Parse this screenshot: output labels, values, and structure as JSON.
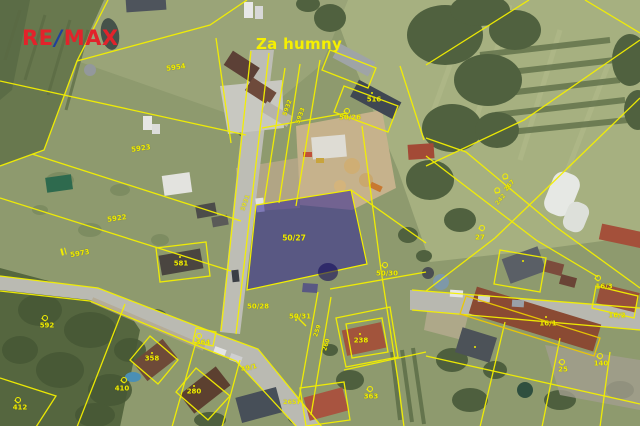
{
  "branding": {
    "re": "RE",
    "slash": "/",
    "max": "MAX",
    "re_color": "#e2232b",
    "slash_color": "#20409a"
  },
  "map": {
    "area_label": "Za humny",
    "highlighted_parcel": {
      "number": "50/27",
      "fill": "rgba(45,35,150,0.55)"
    },
    "line_color": "#f4f000",
    "label_color": "#f0ec00",
    "labels": [
      {
        "t": "5954",
        "x": 176,
        "y": 68,
        "r": -8,
        "s": 7
      },
      {
        "t": "516",
        "x": 374,
        "y": 100,
        "r": 0,
        "s": 7
      },
      {
        "t": "50/26",
        "x": 350,
        "y": 118,
        "r": 0,
        "s": 7
      },
      {
        "t": "5932",
        "x": 288,
        "y": 108,
        "r": -70,
        "s": 6
      },
      {
        "t": "5933",
        "x": 301,
        "y": 116,
        "r": -70,
        "s": 6
      },
      {
        "t": "5923",
        "x": 141,
        "y": 149,
        "r": -8,
        "s": 7
      },
      {
        "t": "5922",
        "x": 117,
        "y": 219,
        "r": -8,
        "s": 7
      },
      {
        "t": "5973",
        "x": 80,
        "y": 254,
        "r": -10,
        "s": 7
      },
      {
        "t": "581",
        "x": 181,
        "y": 264,
        "r": 0,
        "s": 7
      },
      {
        "t": "5931",
        "x": 246,
        "y": 203,
        "r": -70,
        "s": 6,
        "o": 0.75
      },
      {
        "t": "50/27",
        "x": 294,
        "y": 238,
        "r": 0,
        "s": 7.5
      },
      {
        "t": "50/30",
        "x": 387,
        "y": 274,
        "r": 0,
        "s": 7
      },
      {
        "t": "27",
        "x": 480,
        "y": 238,
        "r": 0,
        "s": 7
      },
      {
        "t": "267",
        "x": 510,
        "y": 186,
        "r": -50,
        "s": 6
      },
      {
        "t": "242",
        "x": 501,
        "y": 200,
        "r": -50,
        "s": 6,
        "o": 0.8
      },
      {
        "t": "50/28",
        "x": 258,
        "y": 307,
        "r": 0,
        "s": 7
      },
      {
        "t": "50/31",
        "x": 300,
        "y": 317,
        "r": 0,
        "s": 7
      },
      {
        "t": "259",
        "x": 318,
        "y": 331,
        "r": -72,
        "s": 6
      },
      {
        "t": "260",
        "x": 327,
        "y": 345,
        "r": -72,
        "s": 6
      },
      {
        "t": "49/1",
        "x": 249,
        "y": 368,
        "r": -14,
        "s": 6.5
      },
      {
        "t": "2657",
        "x": 292,
        "y": 402,
        "r": 0,
        "s": 6.5,
        "o": 0.85
      },
      {
        "t": "238",
        "x": 361,
        "y": 341,
        "r": 0,
        "s": 7
      },
      {
        "t": "363",
        "x": 371,
        "y": 397,
        "r": 0,
        "s": 7
      },
      {
        "t": "592",
        "x": 47,
        "y": 326,
        "r": 0,
        "s": 7
      },
      {
        "t": "412",
        "x": 20,
        "y": 408,
        "r": 0,
        "s": 7
      },
      {
        "t": "364",
        "x": 203,
        "y": 343,
        "r": 0,
        "s": 7
      },
      {
        "t": "358",
        "x": 152,
        "y": 359,
        "r": 0,
        "s": 7
      },
      {
        "t": "280",
        "x": 194,
        "y": 392,
        "r": 0,
        "s": 7
      },
      {
        "t": "410",
        "x": 122,
        "y": 389,
        "r": 0,
        "s": 7
      },
      {
        "t": "16/1",
        "x": 548,
        "y": 324,
        "r": 0,
        "s": 7
      },
      {
        "t": "16/2",
        "x": 617,
        "y": 316,
        "r": 0,
        "s": 7
      },
      {
        "t": "16/3",
        "x": 604,
        "y": 287,
        "r": 0,
        "s": 7
      },
      {
        "t": "140",
        "x": 601,
        "y": 364,
        "r": 0,
        "s": 7
      },
      {
        "t": "25",
        "x": 563,
        "y": 370,
        "r": 0,
        "s": 7
      }
    ],
    "landuse_symbols": [
      {
        "x": 346,
        "y": 111,
        "r": 0
      },
      {
        "x": 384,
        "y": 265,
        "r": 0
      },
      {
        "x": 481,
        "y": 228,
        "r": 0
      },
      {
        "x": 505,
        "y": 177,
        "r": -50
      },
      {
        "x": 497,
        "y": 191,
        "r": -50
      },
      {
        "x": 44,
        "y": 318,
        "r": 0
      },
      {
        "x": 17,
        "y": 400,
        "r": 0
      },
      {
        "x": 198,
        "y": 336,
        "r": 0
      },
      {
        "x": 369,
        "y": 389,
        "r": 0
      },
      {
        "x": 123,
        "y": 380,
        "r": 0
      },
      {
        "x": 597,
        "y": 278,
        "r": 0
      },
      {
        "x": 599,
        "y": 356,
        "r": 0
      },
      {
        "x": 561,
        "y": 362,
        "r": 0
      }
    ],
    "building_dots": [
      [
        180,
        257
      ],
      [
        372,
        93
      ],
      [
        360,
        334
      ],
      [
        152,
        353
      ],
      [
        194,
        386
      ],
      [
        546,
        317
      ],
      [
        475,
        347
      ],
      [
        523,
        261
      ],
      [
        296,
        320
      ]
    ],
    "double_bar_symbols": [
      [
        64,
        251,
        -15
      ]
    ]
  }
}
